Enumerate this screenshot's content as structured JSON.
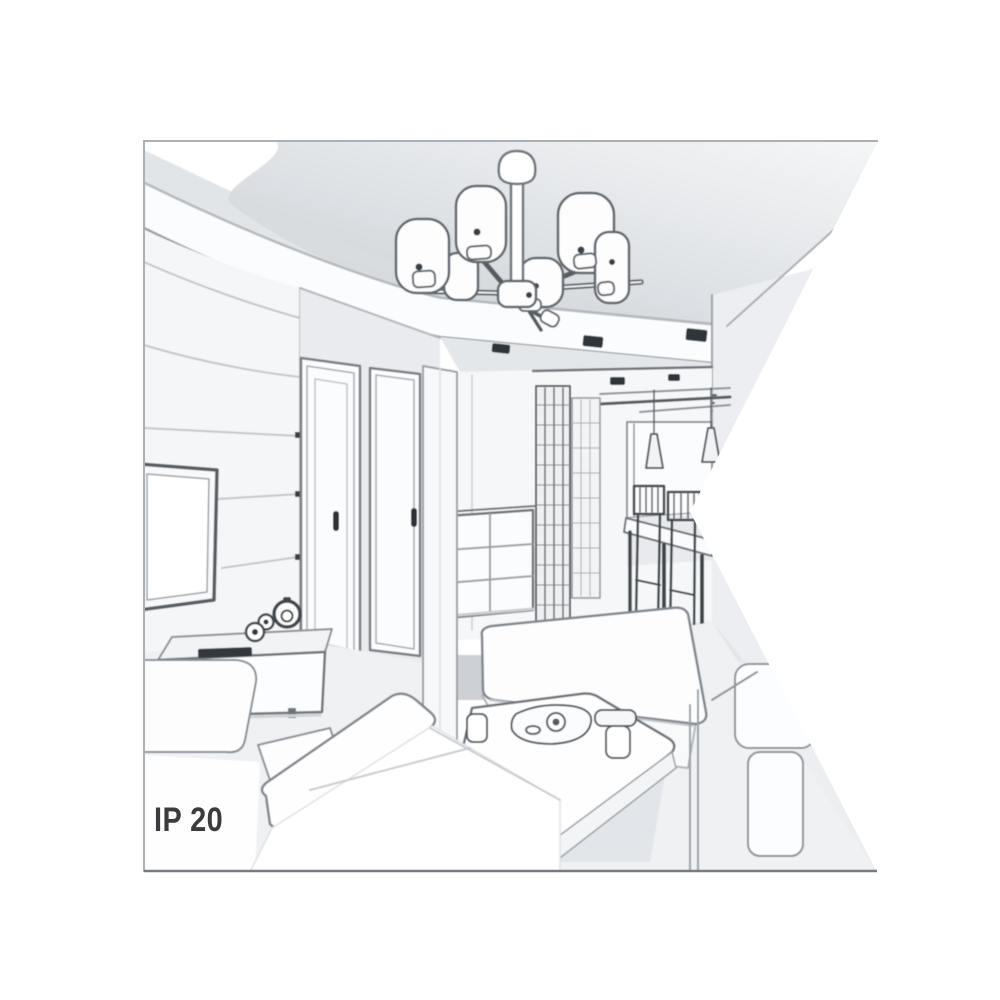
{
  "figure": {
    "kind": "interior-line-sketch-product-image",
    "ip_rating_label": "IP 20",
    "scene_elements": [
      "ceiling-chandelier-six-drum-shades",
      "tray-ceiling-with-spotlights",
      "tv-feature-wall",
      "flat-screen-tv",
      "tv-sideboard-with-clock",
      "two-interior-doors",
      "hallway-wardrobe-grid-doors",
      "chest-of-drawers",
      "dining-table-with-chairs",
      "two-cone-pendant-lights",
      "window",
      "corner-sofa",
      "back-sofa",
      "coffee-table-with-tea-set",
      "right-armchair"
    ],
    "colors": {
      "background": "#ffffff",
      "frame_border_light": "#abb0b5",
      "frame_border_dark": "#767c82",
      "outline": "#6e747a",
      "outline_dark": "#33383d",
      "ceiling_shade": "#d9dce0",
      "wall_shade": "#edeff1",
      "floor_shade": "#eff1f3",
      "label_text": "#3c3c3e"
    }
  }
}
